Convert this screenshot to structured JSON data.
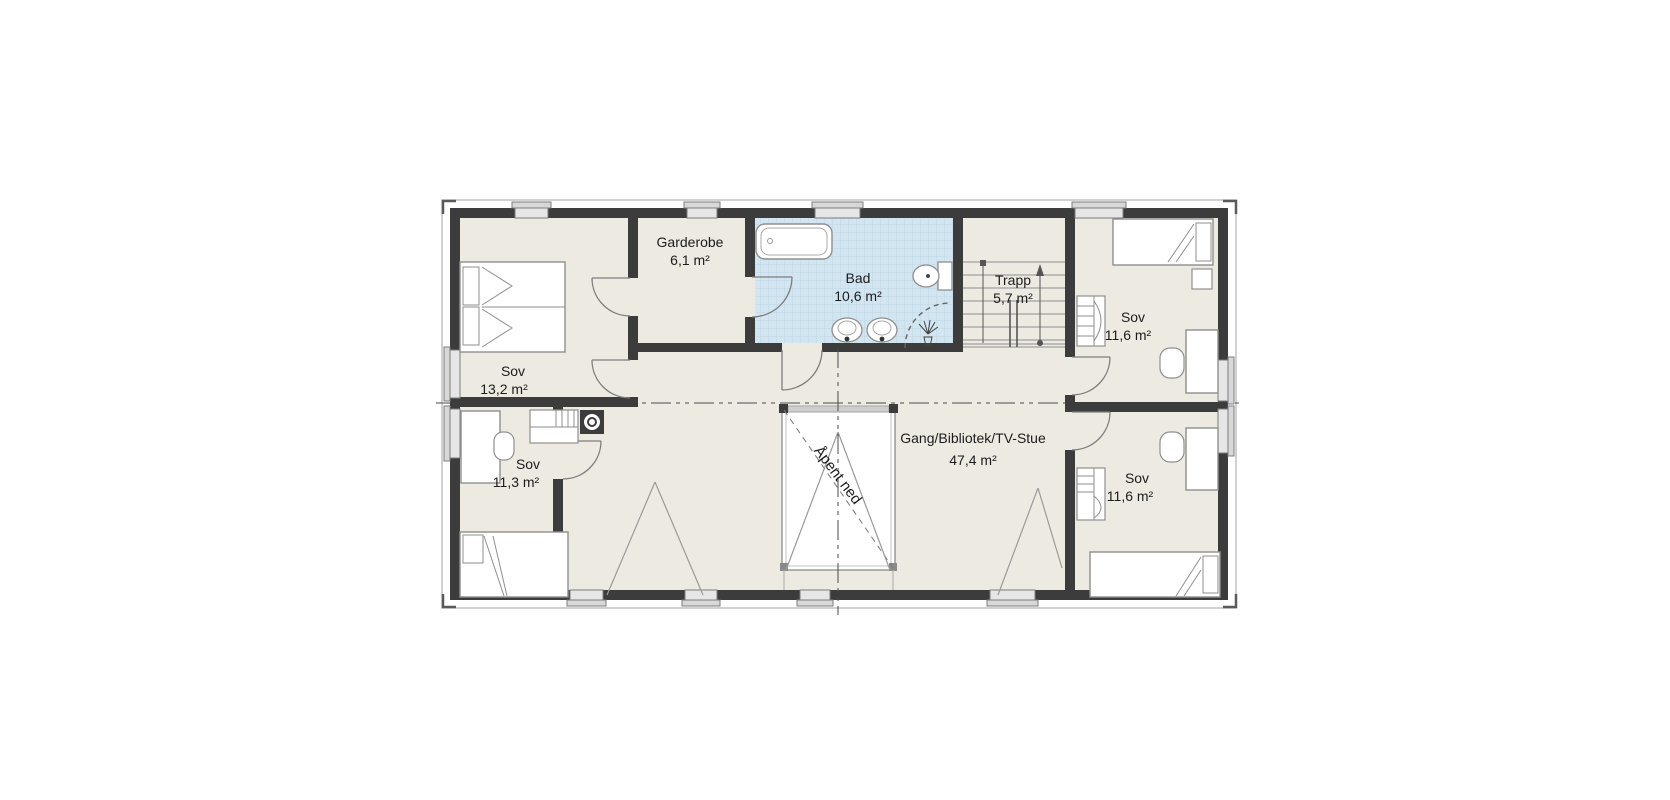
{
  "plan": {
    "kind": "architectural-floor-plan",
    "language": "Norwegian",
    "rooms": [
      {
        "id": "sov-nw",
        "name": "Sov",
        "area": "13,2 m²"
      },
      {
        "id": "garderobe",
        "name": "Garderobe",
        "area": "6,1 m²"
      },
      {
        "id": "bad",
        "name": "Bad",
        "area": "10,6 m²"
      },
      {
        "id": "trapp",
        "name": "Trapp",
        "area": "5,7 m²"
      },
      {
        "id": "sov-ne",
        "name": "Sov",
        "area": "11,6 m²"
      },
      {
        "id": "sov-sw",
        "name": "Sov",
        "area": "11,3 m²"
      },
      {
        "id": "gang",
        "name": "Gang/Bibliotek/TV-Stue",
        "area": "47,4 m²"
      },
      {
        "id": "sov-se",
        "name": "Sov",
        "area": "11,6 m²"
      }
    ],
    "annotations": {
      "open_below": "Åpent ned"
    },
    "fixtures": [
      "double-bed",
      "single-bed",
      "single-bed",
      "single-bed",
      "bathtub",
      "toilet",
      "washbasin",
      "washbasin",
      "shower",
      "stairs",
      "desk",
      "desk",
      "desk",
      "chair",
      "chair",
      "chair",
      "wardrobe",
      "dresser",
      "dresser",
      "nightstand",
      "chimney"
    ],
    "colors": {
      "wall": "#3d3c3c",
      "room_fill": "#edeae1",
      "bathroom_fill": "#d2e5f0",
      "bathroom_grid": "#b9d4e2",
      "furniture_stroke": "#8f8f8f",
      "window_fill": "#e6e6e6",
      "opening_fill": "#ffffff",
      "centerline": "#4a4a4a",
      "text": "#1c1c1c"
    }
  }
}
